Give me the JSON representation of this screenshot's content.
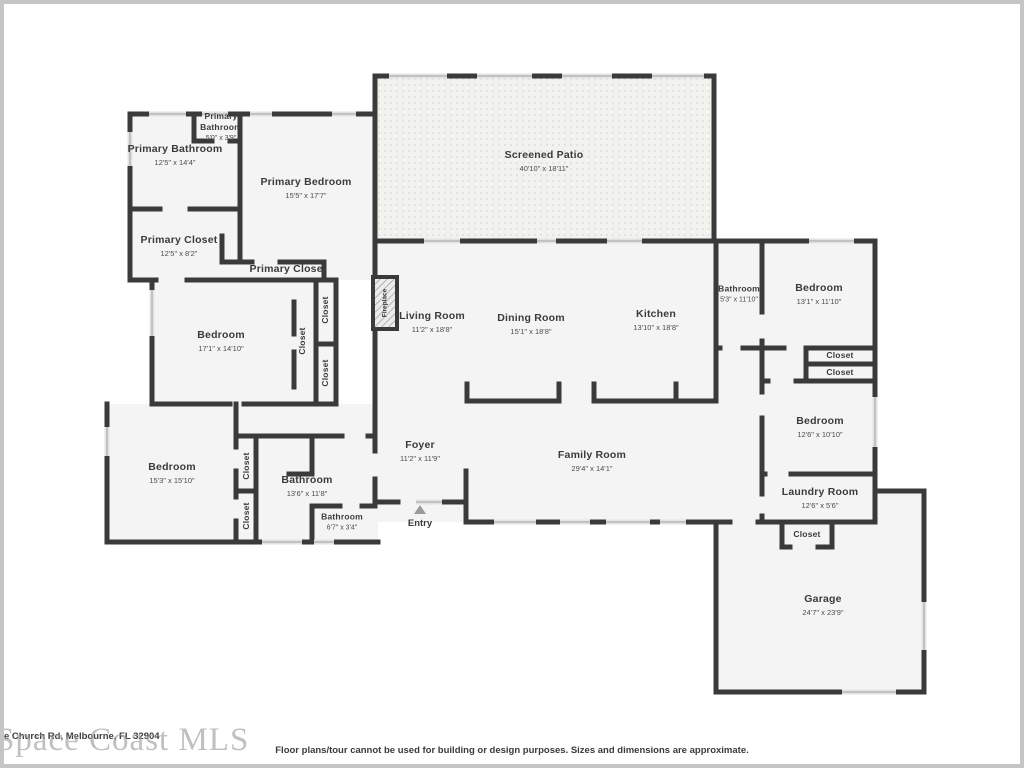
{
  "watermark": "Space Coast MLS",
  "address": "e Church Rd, Melbourne, FL 32904",
  "disclaimer": "Floor plans/tour cannot be used for building or design purposes. Sizes and dimensions are approximate.",
  "labels": {
    "closet": "Closet",
    "fireplace": "Fireplace",
    "entry": "Entry"
  },
  "rooms": {
    "primary_bathroom_small": {
      "name": "Primary Bathroom",
      "dims": "5'0\" x 3'9\""
    },
    "primary_bathroom": {
      "name": "Primary Bathroom",
      "dims": "12'5\" x 14'4\""
    },
    "primary_bedroom": {
      "name": "Primary Bedroom",
      "dims": "15'5\" x 17'7\""
    },
    "primary_closet": {
      "name": "Primary Closet",
      "dims": "12'5\" x 8'2\""
    },
    "primary_closet_2": {
      "name": "Primary Closet"
    },
    "screened_patio": {
      "name": "Screened Patio",
      "dims": "40'10\" x 18'11\""
    },
    "living_room": {
      "name": "Living Room",
      "dims": "11'2\" x 18'8\""
    },
    "dining_room": {
      "name": "Dining Room",
      "dims": "15'1\" x 18'8\""
    },
    "kitchen": {
      "name": "Kitchen",
      "dims": "13'10\" x 18'8\""
    },
    "bathroom_hall": {
      "name": "Bathroom",
      "dims": "5'3\" x 11'10\""
    },
    "bedroom_ne": {
      "name": "Bedroom",
      "dims": "13'1\" x 11'10\""
    },
    "bedroom_w": {
      "name": "Bedroom",
      "dims": "17'1\" x 14'10\""
    },
    "bedroom_sw": {
      "name": "Bedroom",
      "dims": "15'3\" x 15'10\""
    },
    "bathroom_sw": {
      "name": "Bathroom",
      "dims": "13'6\" x 11'8\""
    },
    "bathroom_sw_small": {
      "name": "Bathroom",
      "dims": "6'7\" x 3'4\""
    },
    "foyer": {
      "name": "Foyer",
      "dims": "11'2\" x 11'9\""
    },
    "family_room": {
      "name": "Family Room",
      "dims": "29'4\" x 14'1\""
    },
    "bedroom_e": {
      "name": "Bedroom",
      "dims": "12'6\" x 10'10\""
    },
    "laundry_room": {
      "name": "Laundry Room",
      "dims": "12'6\" x 5'6\""
    },
    "garage": {
      "name": "Garage",
      "dims": "24'7\" x 23'9\""
    }
  }
}
